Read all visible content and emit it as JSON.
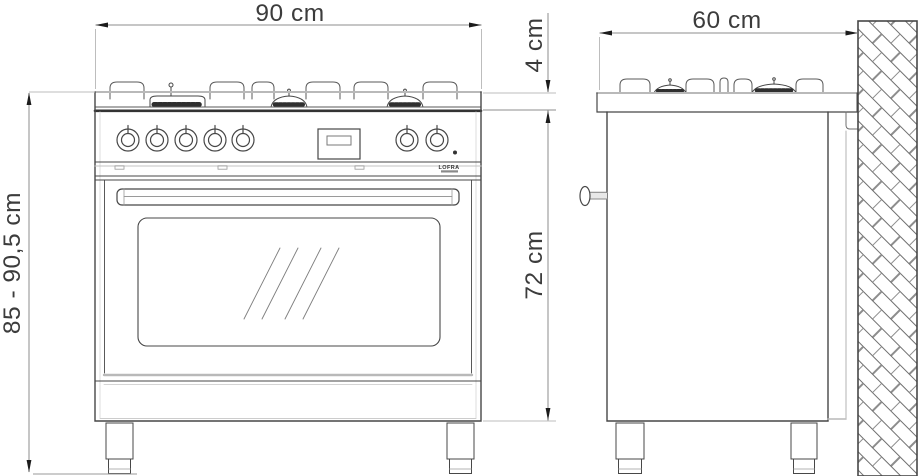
{
  "figure": {
    "type": "technical-dimension-drawing",
    "subject": "freestanding range cooker, front and side elevations against wall",
    "brand": "LOFRA",
    "labels": {
      "front_width": "90 cm",
      "depth": "60 cm",
      "cooktop_edge": "4 cm",
      "oven_section_height": "72 cm",
      "overall_height_range": "85 - 90,5 cm"
    },
    "colors": {
      "background": "#ffffff",
      "outline": "#474747",
      "light_line": "#b9b9b9",
      "dimension_line": "#8c8c8c",
      "arrow": "#1c1c1c",
      "text": "#3c3c3c"
    }
  }
}
